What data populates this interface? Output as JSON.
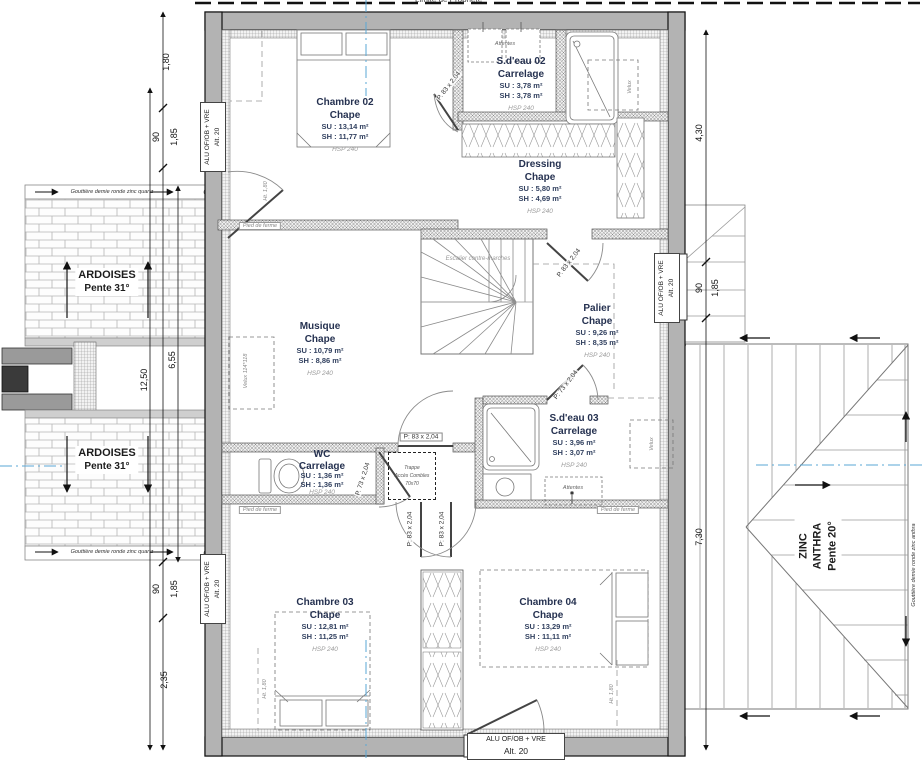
{
  "meta": {
    "property_line": "Limite de Propriété"
  },
  "rooms": {
    "ch02": {
      "name": "Chambre 02",
      "mat": "Chape",
      "su": "SU : 13,14 m²",
      "sh": "SH : 11,77 m²",
      "hsp": "HSP 240"
    },
    "sdeau02": {
      "name": "S.d'eau 02",
      "mat": "Carrelage",
      "su": "SU : 3,78 m²",
      "sh": "SH : 3,78 m²",
      "hsp": "HSP 240"
    },
    "dressing": {
      "name": "Dressing",
      "mat": "Chape",
      "su": "SU : 5,80 m²",
      "sh": "SH : 4,69 m²",
      "hsp": "HSP 240"
    },
    "musique": {
      "name": "Musique",
      "mat": "Chape",
      "su": "SU : 10,79 m²",
      "sh": "SH : 8,86 m²",
      "hsp": "HSP 240"
    },
    "palier": {
      "name": "Palier",
      "mat": "Chape",
      "su": "SU : 9,26 m²",
      "sh": "SH : 8,35 m²",
      "hsp": "HSP 240"
    },
    "wc": {
      "name": "WC",
      "mat": "Carrelage",
      "su": "SU : 1,36 m²",
      "sh": "SH : 1,36 m²",
      "hsp": "HSP 240"
    },
    "sdeau03": {
      "name": "S.d'eau 03",
      "mat": "Carrelage",
      "su": "SU : 3,96 m²",
      "sh": "SH : 3,07 m²",
      "hsp": "HSP 240"
    },
    "ch03": {
      "name": "Chambre 03",
      "mat": "Chape",
      "su": "SU : 12,81 m²",
      "sh": "SH : 11,25 m²",
      "hsp": "HSP 240"
    },
    "ch04": {
      "name": "Chambre 04",
      "mat": "Chape",
      "su": "SU : 13,29 m²",
      "sh": "SH : 11,11 m²",
      "hsp": "HSP 240"
    }
  },
  "roof_left": {
    "name": "ARDOISES",
    "slope": "Pente 31°",
    "gutter": "Gouttière demie ronde zinc quartz"
  },
  "roof_right": {
    "name": "ZINC",
    "name2": "ANTHRA",
    "slope": "Pente 20°",
    "gutter": "Gouttière demie ronde zinc anthra"
  },
  "window_label": {
    "type": "ALU OF/OB + VRE",
    "alt": "Alt. 20"
  },
  "doors": {
    "p83": "P: 83 x 2,04",
    "p83_alt": "P. 83 x 2,04",
    "p73": "P: 73 x 2,04",
    "p73_alt": "P. 73 x 2,04"
  },
  "stairs": {
    "label": "Escalier contre-marches"
  },
  "notes": {
    "trappe_1": "Trappe",
    "trappe_2": "Accès Combles",
    "trappe_3": "70x70",
    "attentes": "Attentes",
    "pied_de_ferme": "Pied de ferme",
    "velux": "Velux",
    "velux_size": "114*118",
    "height_line": "Ht. 1,80"
  },
  "dimensions": {
    "left": {
      "d1": "1,80",
      "d2": "90",
      "d3": "1,85",
      "d4": "12,50",
      "d5": "6,55",
      "d6": "90",
      "d7": "1,85",
      "d8": "2,35"
    },
    "right": {
      "d1": "4,30",
      "d2": "90",
      "d3": "1,85",
      "d4": "7,30"
    }
  },
  "colors": {
    "axis_blue": "#5aa7d6",
    "wall_gray": "#b3b3b3",
    "line_dark": "#1a1a1a",
    "room_text": "#24314e"
  }
}
